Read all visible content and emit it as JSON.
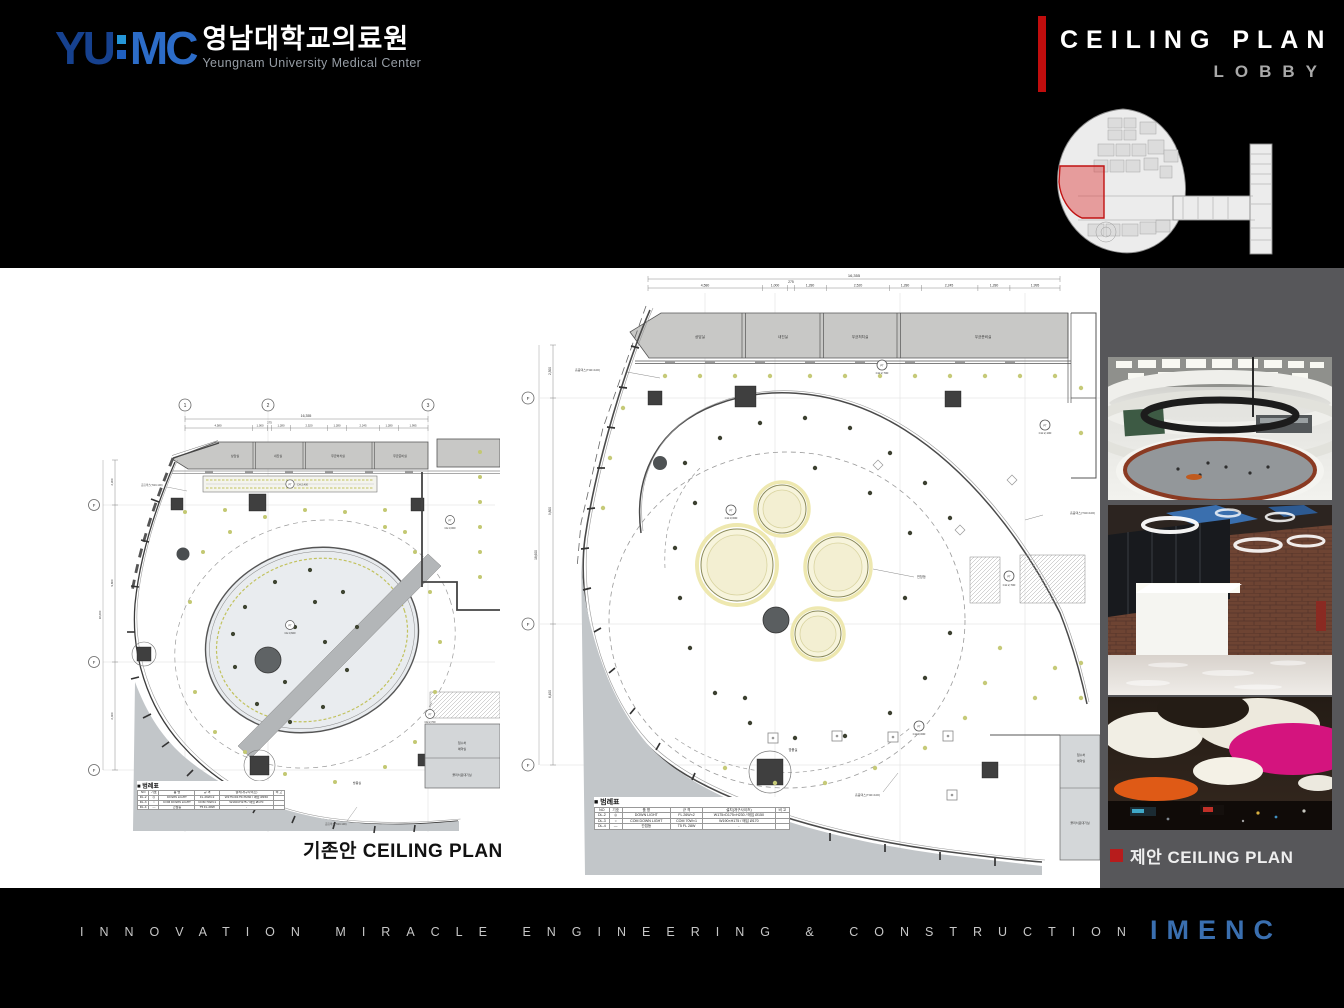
{
  "header": {
    "logo": {
      "acronym_left": "YU",
      "acronym_right": "MC",
      "korean": "영남대학교의료원",
      "english": "Yeungnam University Medical Center"
    },
    "title": "CEILING PLAN",
    "subtitle": "LOBBY"
  },
  "colors": {
    "accent_red": "#c00d0d",
    "keymap_highlight": "#c01212",
    "sidebar_gray": "#57575a",
    "logo_blue_dark": "#16418f",
    "logo_blue": "#2c6cc8",
    "brand_blue": "#3a6fb0",
    "plan_yellow_ring": "#c2c25e",
    "plan_circle_fill": "#f7f4dc"
  },
  "grid": {
    "top": [
      "1",
      "2",
      "3"
    ],
    "left_label": "F"
  },
  "plan_dims": {
    "total": "16,355",
    "segments": [
      "4,580",
      "1,000",
      "275",
      "1,280",
      "2,520",
      "1,280",
      "2,245",
      "1,280",
      "1,995"
    ],
    "left_segments": [
      "2,300",
      "9,800",
      "6,400"
    ],
    "left_total": "18,600"
  },
  "rooms": {
    "top": [
      "상담실",
      "내진실",
      "무균처치실",
      "무균준비실"
    ],
    "right_small": [
      "접수처",
      "예약실"
    ],
    "bottom_right": "물리치료대기실",
    "vestibule": "방풍실"
  },
  "notes": {
    "acoustic": "흡음텍스(T40×100)",
    "pendant": "천창등",
    "cove_ch": "CH:2,400",
    "symbol": "PT",
    "ch_labels": [
      "CH:2,700",
      "CH:2,100",
      "CH:3,600",
      "CH:2,700",
      "CH:3,000"
    ]
  },
  "legend": {
    "title": "■ 범례표",
    "headers": [
      "NO",
      "기호",
      "품 명",
      "규 격",
      "설치(개구사이즈)",
      "비 고"
    ],
    "rows": [
      {
        "no": "DL-2",
        "sym": "◎",
        "name": "DOWN LIGHT",
        "spec": "FL 26W×2",
        "size": "W175×D175×H230 / 매입 Ø150",
        "note": ""
      },
      {
        "no": "DL-3",
        "sym": "○",
        "name": "COM DOWN LIGHT",
        "spec": "COM 70W×1",
        "size": "W190×H175 / 매입 Ø170",
        "note": ""
      },
      {
        "no": "DL-4",
        "sym": "—",
        "name": "간접등",
        "spec": "T5 FL 28W",
        "size": "-",
        "note": ""
      }
    ]
  },
  "captions": {
    "existing": "기존안 CEILING PLAN",
    "proposed": "제안 CEILING PLAN"
  },
  "footer": {
    "tagline": "INNOVATION MIRACLE ENGINEERING & CONSTRUCTION",
    "brand": "IMENC"
  }
}
